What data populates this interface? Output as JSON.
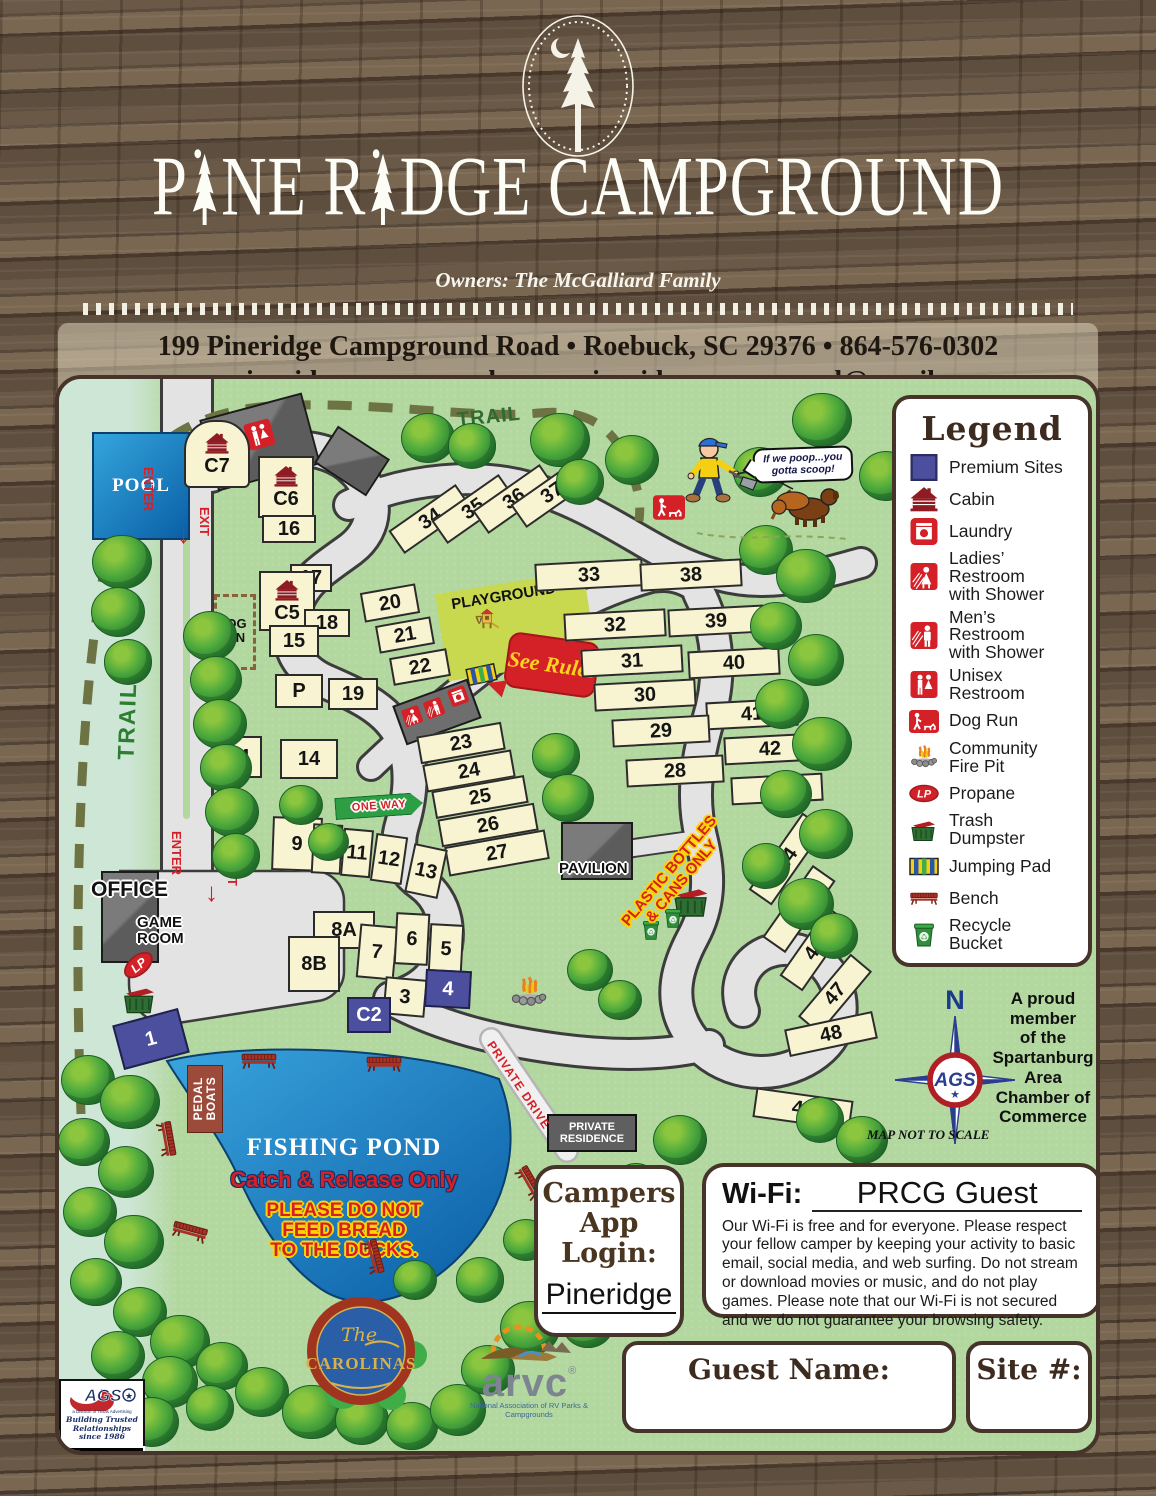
{
  "header": {
    "title": "PINE RIDGE CAMPGROUND",
    "title_p1": "P",
    "title_p2": "NE R",
    "title_p3": "DGE CAMPGROUND",
    "owners": "Owners:  The McGalliard Family",
    "address_line1": "199 Pineridge Campground Road   •   Roebuck, SC 29376   •   864-576-0302",
    "address_line2": "www.pineridgecampground.com   •   pineridgecampground@gmail.com"
  },
  "colors": {
    "premium": "#4c4f9d",
    "standard_site": "#f8f3d0",
    "accent_red": "#d42127",
    "map_green": "#b2d79f",
    "pond_blue": "#1f8fd0",
    "road_gray": "#e3e3e3",
    "box_border_brown": "#46342a"
  },
  "legend": {
    "title": "Legend",
    "items": [
      {
        "icon": "premium-swatch",
        "label": "Premium Sites"
      },
      {
        "icon": "cabin-icon",
        "label": "Cabin"
      },
      {
        "icon": "laundry-icon",
        "label": "Laundry"
      },
      {
        "icon": "ladies-restroom-icon",
        "label": "Ladies’\nRestroom\nwith Shower"
      },
      {
        "icon": "mens-restroom-icon",
        "label": "Men’s\nRestroom\nwith Shower"
      },
      {
        "icon": "unisex-restroom-icon",
        "label": "Unisex\nRestroom"
      },
      {
        "icon": "dog-run-icon",
        "label": "Dog Run"
      },
      {
        "icon": "fire-pit-icon",
        "label": "Community\nFire Pit"
      },
      {
        "icon": "propane-icon",
        "label": "Propane"
      },
      {
        "icon": "dumpster-icon",
        "label": "Trash\nDumpster"
      },
      {
        "icon": "jumping-pad-icon",
        "label": "Jumping Pad"
      },
      {
        "icon": "bench-icon",
        "label": "Bench"
      },
      {
        "icon": "recycle-icon",
        "label": "Recycle\nBucket"
      }
    ]
  },
  "map": {
    "labels": {
      "pool": "POOL",
      "trail_left": "TRAIL",
      "trail_top": "TRAIL",
      "enter": "ENTER",
      "exit": "EXIT",
      "dog_run": "DOG\nRUN",
      "playground": "PLAYGROUND",
      "see_rules": "See\nRules",
      "one_way": "ONE WAY",
      "pavilion": "PAVILION",
      "office": "OFFICE",
      "game_room": "GAME\nROOM",
      "lp": "LP",
      "pedal_boats": "PEDAL\nBOATS",
      "fishing_pond": "FISHING POND",
      "catch_release": "Catch & Release Only",
      "no_bread": "PLEASE DO NOT\nFEED BREAD\nTO THE DUCKS.",
      "plastic_only": "PLASTIC BOTTLES\n& CANS ONLY",
      "private_drive": "PRIVATE DRIVE",
      "private_residence": "PRIVATE\nRESIDENCE",
      "speech_bubble": "If we poop...you\ngotta scoop!",
      "north": "N",
      "not_to_scale": "MAP NOT TO SCALE",
      "proud_member": "A proud\nmember\nof the\nSpartanburg\nArea\nChamber of\nCommerce"
    },
    "site_fields": [
      "label",
      "x",
      "y",
      "w",
      "h",
      "rot",
      "premium",
      "cabin",
      "arch"
    ],
    "sites": [
      [
        "C7",
        158,
        75,
        66,
        68,
        0,
        0,
        1,
        1
      ],
      [
        "C6",
        227,
        108,
        56,
        62,
        0,
        0,
        1,
        0
      ],
      [
        "16",
        230,
        150,
        54,
        28,
        0,
        0,
        0,
        0
      ],
      [
        "17",
        252,
        199,
        42,
        28,
        0,
        0,
        0,
        0
      ],
      [
        "C5",
        228,
        222,
        56,
        60,
        0,
        0,
        1,
        0
      ],
      [
        "18",
        268,
        244,
        46,
        28,
        0,
        0,
        0,
        0
      ],
      [
        "15",
        235,
        262,
        50,
        32,
        0,
        0,
        0,
        0
      ],
      [
        "P",
        240,
        312,
        48,
        34,
        0,
        0,
        0,
        0
      ],
      [
        "19",
        294,
        315,
        50,
        32,
        0,
        0,
        0,
        0
      ],
      [
        "C4",
        178,
        378,
        50,
        42,
        0,
        0,
        0,
        0
      ],
      [
        "14",
        250,
        380,
        58,
        40,
        0,
        0,
        0,
        0
      ],
      [
        "20",
        331,
        224,
        56,
        30,
        -10,
        0,
        0,
        0
      ],
      [
        "21",
        346,
        256,
        56,
        28,
        -10,
        0,
        0,
        0
      ],
      [
        "22",
        361,
        288,
        58,
        28,
        -10,
        0,
        0,
        0
      ],
      [
        "23",
        402,
        364,
        86,
        28,
        -10,
        0,
        0,
        0
      ],
      [
        "24",
        410,
        392,
        90,
        28,
        -10,
        0,
        0,
        0
      ],
      [
        "25",
        421,
        418,
        94,
        28,
        -10,
        0,
        0,
        0
      ],
      [
        "26",
        429,
        446,
        98,
        28,
        -10,
        0,
        0,
        0
      ],
      [
        "27",
        438,
        474,
        102,
        30,
        -10,
        0,
        0,
        0
      ],
      [
        "34",
        371,
        140,
        82,
        28,
        -35,
        0,
        0,
        0
      ],
      [
        "35",
        414,
        130,
        82,
        28,
        -35,
        0,
        0,
        0
      ],
      [
        "36",
        455,
        120,
        82,
        28,
        -35,
        0,
        0,
        0
      ],
      [
        "37",
        493,
        114,
        82,
        28,
        -35,
        0,
        0,
        0
      ],
      [
        "33",
        530,
        196,
        108,
        28,
        -3,
        0,
        0,
        0
      ],
      [
        "38",
        632,
        196,
        102,
        28,
        -3,
        0,
        0,
        0
      ],
      [
        "32",
        556,
        246,
        102,
        28,
        -3,
        0,
        0,
        0
      ],
      [
        "39",
        657,
        242,
        96,
        28,
        -3,
        0,
        0,
        0
      ],
      [
        "31",
        573,
        282,
        102,
        28,
        -3,
        0,
        0,
        0
      ],
      [
        "40",
        675,
        284,
        92,
        28,
        -3,
        0,
        0,
        0
      ],
      [
        "30",
        586,
        316,
        102,
        28,
        -3,
        0,
        0,
        0
      ],
      [
        "41",
        693,
        335,
        92,
        28,
        -3,
        0,
        0,
        0
      ],
      [
        "29",
        602,
        352,
        98,
        28,
        -3,
        0,
        0,
        0
      ],
      [
        "42",
        711,
        370,
        92,
        28,
        -3,
        0,
        0,
        0
      ],
      [
        "28",
        616,
        392,
        98,
        28,
        -3,
        0,
        0,
        0
      ],
      [
        "43",
        718,
        410,
        92,
        28,
        -3,
        0,
        0,
        0
      ],
      [
        "44",
        728,
        480,
        94,
        28,
        -55,
        0,
        0,
        0
      ],
      [
        "45",
        740,
        530,
        88,
        28,
        -55,
        0,
        0,
        0
      ],
      [
        "46",
        756,
        570,
        84,
        28,
        -55,
        0,
        0,
        0
      ],
      [
        "47",
        776,
        615,
        82,
        28,
        -50,
        0,
        0,
        0
      ],
      [
        "48",
        772,
        655,
        90,
        28,
        -12,
        0,
        0,
        0
      ],
      [
        "49",
        744,
        730,
        98,
        30,
        8,
        0,
        0,
        0
      ],
      [
        "9",
        238,
        465,
        50,
        54,
        2,
        0,
        0,
        0
      ],
      [
        "10",
        268,
        470,
        30,
        50,
        3,
        0,
        0,
        0
      ],
      [
        "11",
        298,
        474,
        30,
        48,
        5,
        0,
        0,
        0
      ],
      [
        "12",
        330,
        480,
        32,
        48,
        8,
        0,
        0,
        0
      ],
      [
        "13",
        367,
        492,
        34,
        50,
        12,
        0,
        0,
        0
      ],
      [
        "8A",
        285,
        551,
        62,
        38,
        0,
        0,
        0,
        0
      ],
      [
        "8B",
        255,
        585,
        52,
        56,
        0,
        0,
        0,
        0
      ],
      [
        "7",
        318,
        573,
        38,
        54,
        5,
        0,
        0,
        0
      ],
      [
        "6",
        353,
        560,
        34,
        52,
        3,
        0,
        0,
        0
      ],
      [
        "5",
        387,
        570,
        34,
        50,
        3,
        0,
        0,
        0
      ],
      [
        "3",
        346,
        618,
        42,
        38,
        5,
        0,
        0,
        0
      ],
      [
        "4",
        389,
        610,
        46,
        38,
        3,
        1,
        0,
        0
      ],
      [
        "C2",
        310,
        636,
        44,
        36,
        0,
        1,
        0,
        0
      ],
      [
        "1",
        92,
        660,
        68,
        46,
        -15,
        1,
        0,
        0
      ]
    ],
    "trees": [
      [
        368,
        58,
        1.0
      ],
      [
        412,
        66,
        0.9
      ],
      [
        500,
        60,
        1.1
      ],
      [
        520,
        102,
        0.9
      ],
      [
        572,
        80,
        1.0
      ],
      [
        700,
        92,
        1.0
      ],
      [
        762,
        40,
        1.1
      ],
      [
        826,
        96,
        1.0
      ],
      [
        62,
        182,
        1.1
      ],
      [
        58,
        232,
        1.0
      ],
      [
        68,
        282,
        0.9
      ],
      [
        150,
        256,
        1.0
      ],
      [
        156,
        300,
        0.95
      ],
      [
        160,
        344,
        1.0
      ],
      [
        166,
        388,
        0.95
      ],
      [
        172,
        432,
        1.0
      ],
      [
        176,
        476,
        0.9
      ],
      [
        706,
        170,
        1.0
      ],
      [
        746,
        196,
        1.1
      ],
      [
        716,
        246,
        0.95
      ],
      [
        756,
        280,
        1.05
      ],
      [
        722,
        324,
        1.0
      ],
      [
        762,
        364,
        1.1
      ],
      [
        726,
        414,
        0.95
      ],
      [
        766,
        454,
        1.0
      ],
      [
        706,
        486,
        0.9
      ],
      [
        746,
        524,
        1.05
      ],
      [
        774,
        556,
        0.9
      ],
      [
        496,
        376,
        0.9
      ],
      [
        508,
        418,
        0.95
      ],
      [
        241,
        425,
        0.8
      ],
      [
        268,
        462,
        0.75
      ],
      [
        28,
        700,
        1.0
      ],
      [
        70,
        722,
        1.1
      ],
      [
        24,
        762,
        0.95
      ],
      [
        66,
        792,
        1.05
      ],
      [
        30,
        832,
        1.0
      ],
      [
        74,
        862,
        1.1
      ],
      [
        36,
        902,
        0.95
      ],
      [
        80,
        932,
        1.0
      ],
      [
        120,
        962,
        1.1
      ],
      [
        58,
        976,
        1.0
      ],
      [
        162,
        986,
        0.95
      ],
      [
        110,
        1002,
        1.05
      ],
      [
        202,
        1012,
        1.0
      ],
      [
        252,
        1032,
        1.1
      ],
      [
        150,
        1028,
        0.9
      ],
      [
        92,
        1042,
        1.0
      ],
      [
        302,
        1040,
        1.0
      ],
      [
        352,
        1046,
        0.95
      ],
      [
        398,
        1030,
        1.05
      ],
      [
        428,
        990,
        1.0
      ],
      [
        470,
        948,
        1.1
      ],
      [
        420,
        900,
        0.9
      ],
      [
        466,
        860,
        0.85
      ],
      [
        355,
        900,
        0.8
      ],
      [
        528,
        944,
        0.95
      ],
      [
        576,
        806,
        0.9
      ],
      [
        620,
        760,
        1.0
      ],
      [
        760,
        740,
        0.9
      ],
      [
        802,
        760,
        0.95
      ],
      [
        530,
        590,
        0.85
      ],
      [
        560,
        620,
        0.8
      ]
    ],
    "benches": [
      [
        200,
        674,
        0
      ],
      [
        325,
        677,
        0
      ],
      [
        105,
        750,
        80
      ],
      [
        130,
        845,
        15
      ],
      [
        312,
        868,
        75
      ],
      [
        468,
        795,
        60
      ]
    ]
  },
  "wifi": {
    "label": "Wi-Fi:",
    "network": "PRCG Guest",
    "body": "Our Wi-Fi is free and for everyone. Please respect your fellow camper by keeping your activity to basic email, social media, and web surfing. Do not stream or download movies or music, and do not play games. Please note that our Wi-Fi is not secured and we do not guarantee your browsing safety."
  },
  "campers_app": {
    "title": "Campers\nApp\nLogin:",
    "password": "Pineridge"
  },
  "guest_box": {
    "label": "Guest Name:"
  },
  "site_box": {
    "label": "Site #:"
  },
  "footer_logos": {
    "carolinas_the": "The",
    "carolinas_name": "CAROLINAS",
    "arvc_name": "arvc",
    "arvc_reg": "®",
    "arvc_tagline": "National Association of RV Parks & Campgrounds",
    "ags_name": "AGS",
    "ags_division": "a Division of Texas Advertising",
    "ags_script": "Building Trusted\nRelationships since 1986",
    "ags_years": "2019-2020"
  }
}
